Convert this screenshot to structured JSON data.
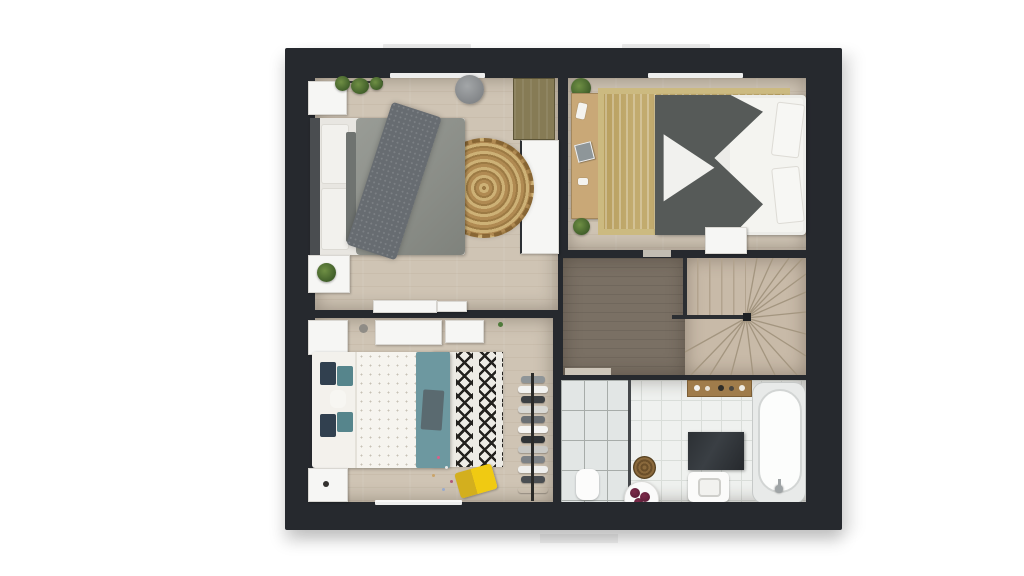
{
  "page": {
    "kind": "3d-floor-plan-top-view",
    "background": "#ffffff"
  },
  "palette": {
    "exterior_wall": "#26292e",
    "wood_light": "#cfc4b4",
    "wood_dark": "#7a7064",
    "stair_tread": "#c8baa8",
    "bathroom_tile": "#eff1ef",
    "jute_rug": "#b08a52",
    "tan_striped_rug": "#c2ab6e",
    "gray_duvet": "#8a8d87",
    "dark_duvet": "#565a58",
    "teal_accent": "#6d98a0",
    "navy_pillow": "#31404f",
    "yellow_chair": "#f0ca12",
    "towel_maroon": "#6b2340"
  },
  "rooms": [
    {
      "id": "bedroom-top-left",
      "items": [
        "double-bed-gray-bedding",
        "headboard",
        "nightstand-top",
        "nightstand-with-plant",
        "hanging-plants",
        "gray-pouf",
        "round-jute-rug",
        "wood-wardrobe",
        "white-wardrobe",
        "white-sideboard",
        "window"
      ]
    },
    {
      "id": "bedroom-top-right",
      "items": [
        "double-bed-dark-and-white-bedding",
        "pillows",
        "desk-console-with-decor",
        "potted-plant-top",
        "potted-plant-bottom",
        "tan-striped-rug",
        "small-white-table",
        "window"
      ]
    },
    {
      "id": "landing-hallway",
      "items": [
        "dark-wood-floor",
        "door-threshold"
      ]
    },
    {
      "id": "staircase",
      "items": [
        "straight-flight",
        "winder-fan-treads",
        "banister",
        "newel-post"
      ]
    },
    {
      "id": "bedroom-bottom-left",
      "items": [
        "double-bed-white-dotted-duvet",
        "navy-teal-pillows",
        "teal-foot-bench",
        "zigzag-ikat-rug",
        "yellow-kids-chair",
        "confetti-toys",
        "clothes-rack",
        "nightstand-top",
        "nightstand-bottom",
        "wall-cabinets",
        "window"
      ]
    },
    {
      "id": "bathroom",
      "items": [
        "walk-in-shower-glass",
        "shower-mat",
        "round-woven-basket",
        "towel-side-table",
        "wall-shelf-toiletries",
        "dark-vanity-counter",
        "toilet",
        "bathtub-with-faucet"
      ]
    }
  ]
}
